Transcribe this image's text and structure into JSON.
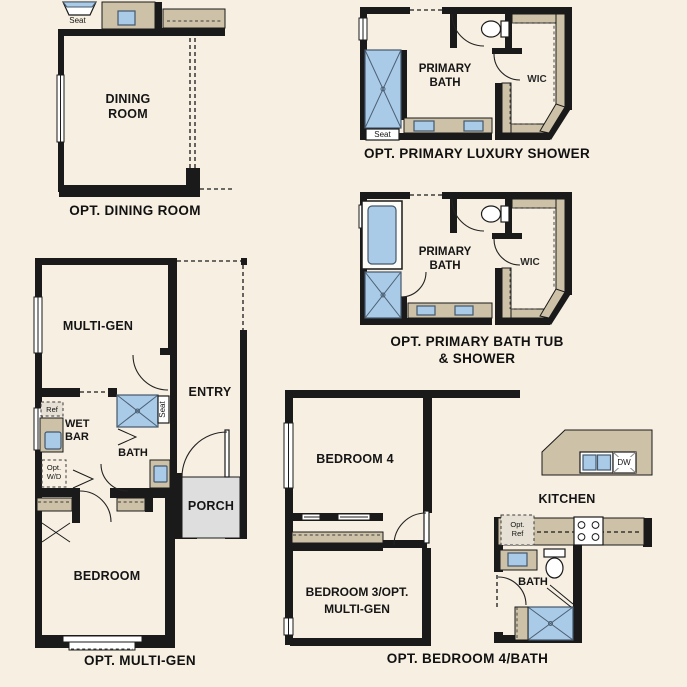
{
  "sheet": {
    "background": "#f7f0e2"
  },
  "colors": {
    "wall": "#1a1a1a",
    "counter_tan": "#cdc2a7",
    "fixture_blue": "#a9cbe8",
    "fixture_blue_border": "#44576b",
    "porch_gray": "#dedede",
    "text": "#151515"
  },
  "plans": {
    "dining": {
      "caption": "OPT. DINING ROOM",
      "room": "DINING\nROOM",
      "seat": "Seat"
    },
    "luxury_shower": {
      "caption": "OPT. PRIMARY LUXURY SHOWER",
      "room": "PRIMARY\nBATH",
      "wic": "WIC",
      "seat": "Seat"
    },
    "tub_shower": {
      "caption": "OPT. PRIMARY BATH TUB\n& SHOWER",
      "room": "PRIMARY\nBATH",
      "wic": "WIC"
    },
    "multi_gen": {
      "caption": "OPT. MULTI-GEN",
      "multi_gen": "MULTI-GEN",
      "entry": "ENTRY",
      "ref": "Ref",
      "wet_bar": "WET\nBAR",
      "opt_wd": "Opt.\nW/D",
      "seat": "Seat",
      "bath": "BATH",
      "porch": "PORCH",
      "bedroom": "BEDROOM"
    },
    "bedroom4": {
      "caption": "OPT. BEDROOM 4/BATH",
      "bedroom4": "BEDROOM 4",
      "kitchen": "KITCHEN",
      "dw": "DW",
      "opt_ref": "Opt.\nRef",
      "bath": "BATH",
      "bedroom3": "BEDROOM 3/OPT.\nMULTI-GEN"
    }
  }
}
